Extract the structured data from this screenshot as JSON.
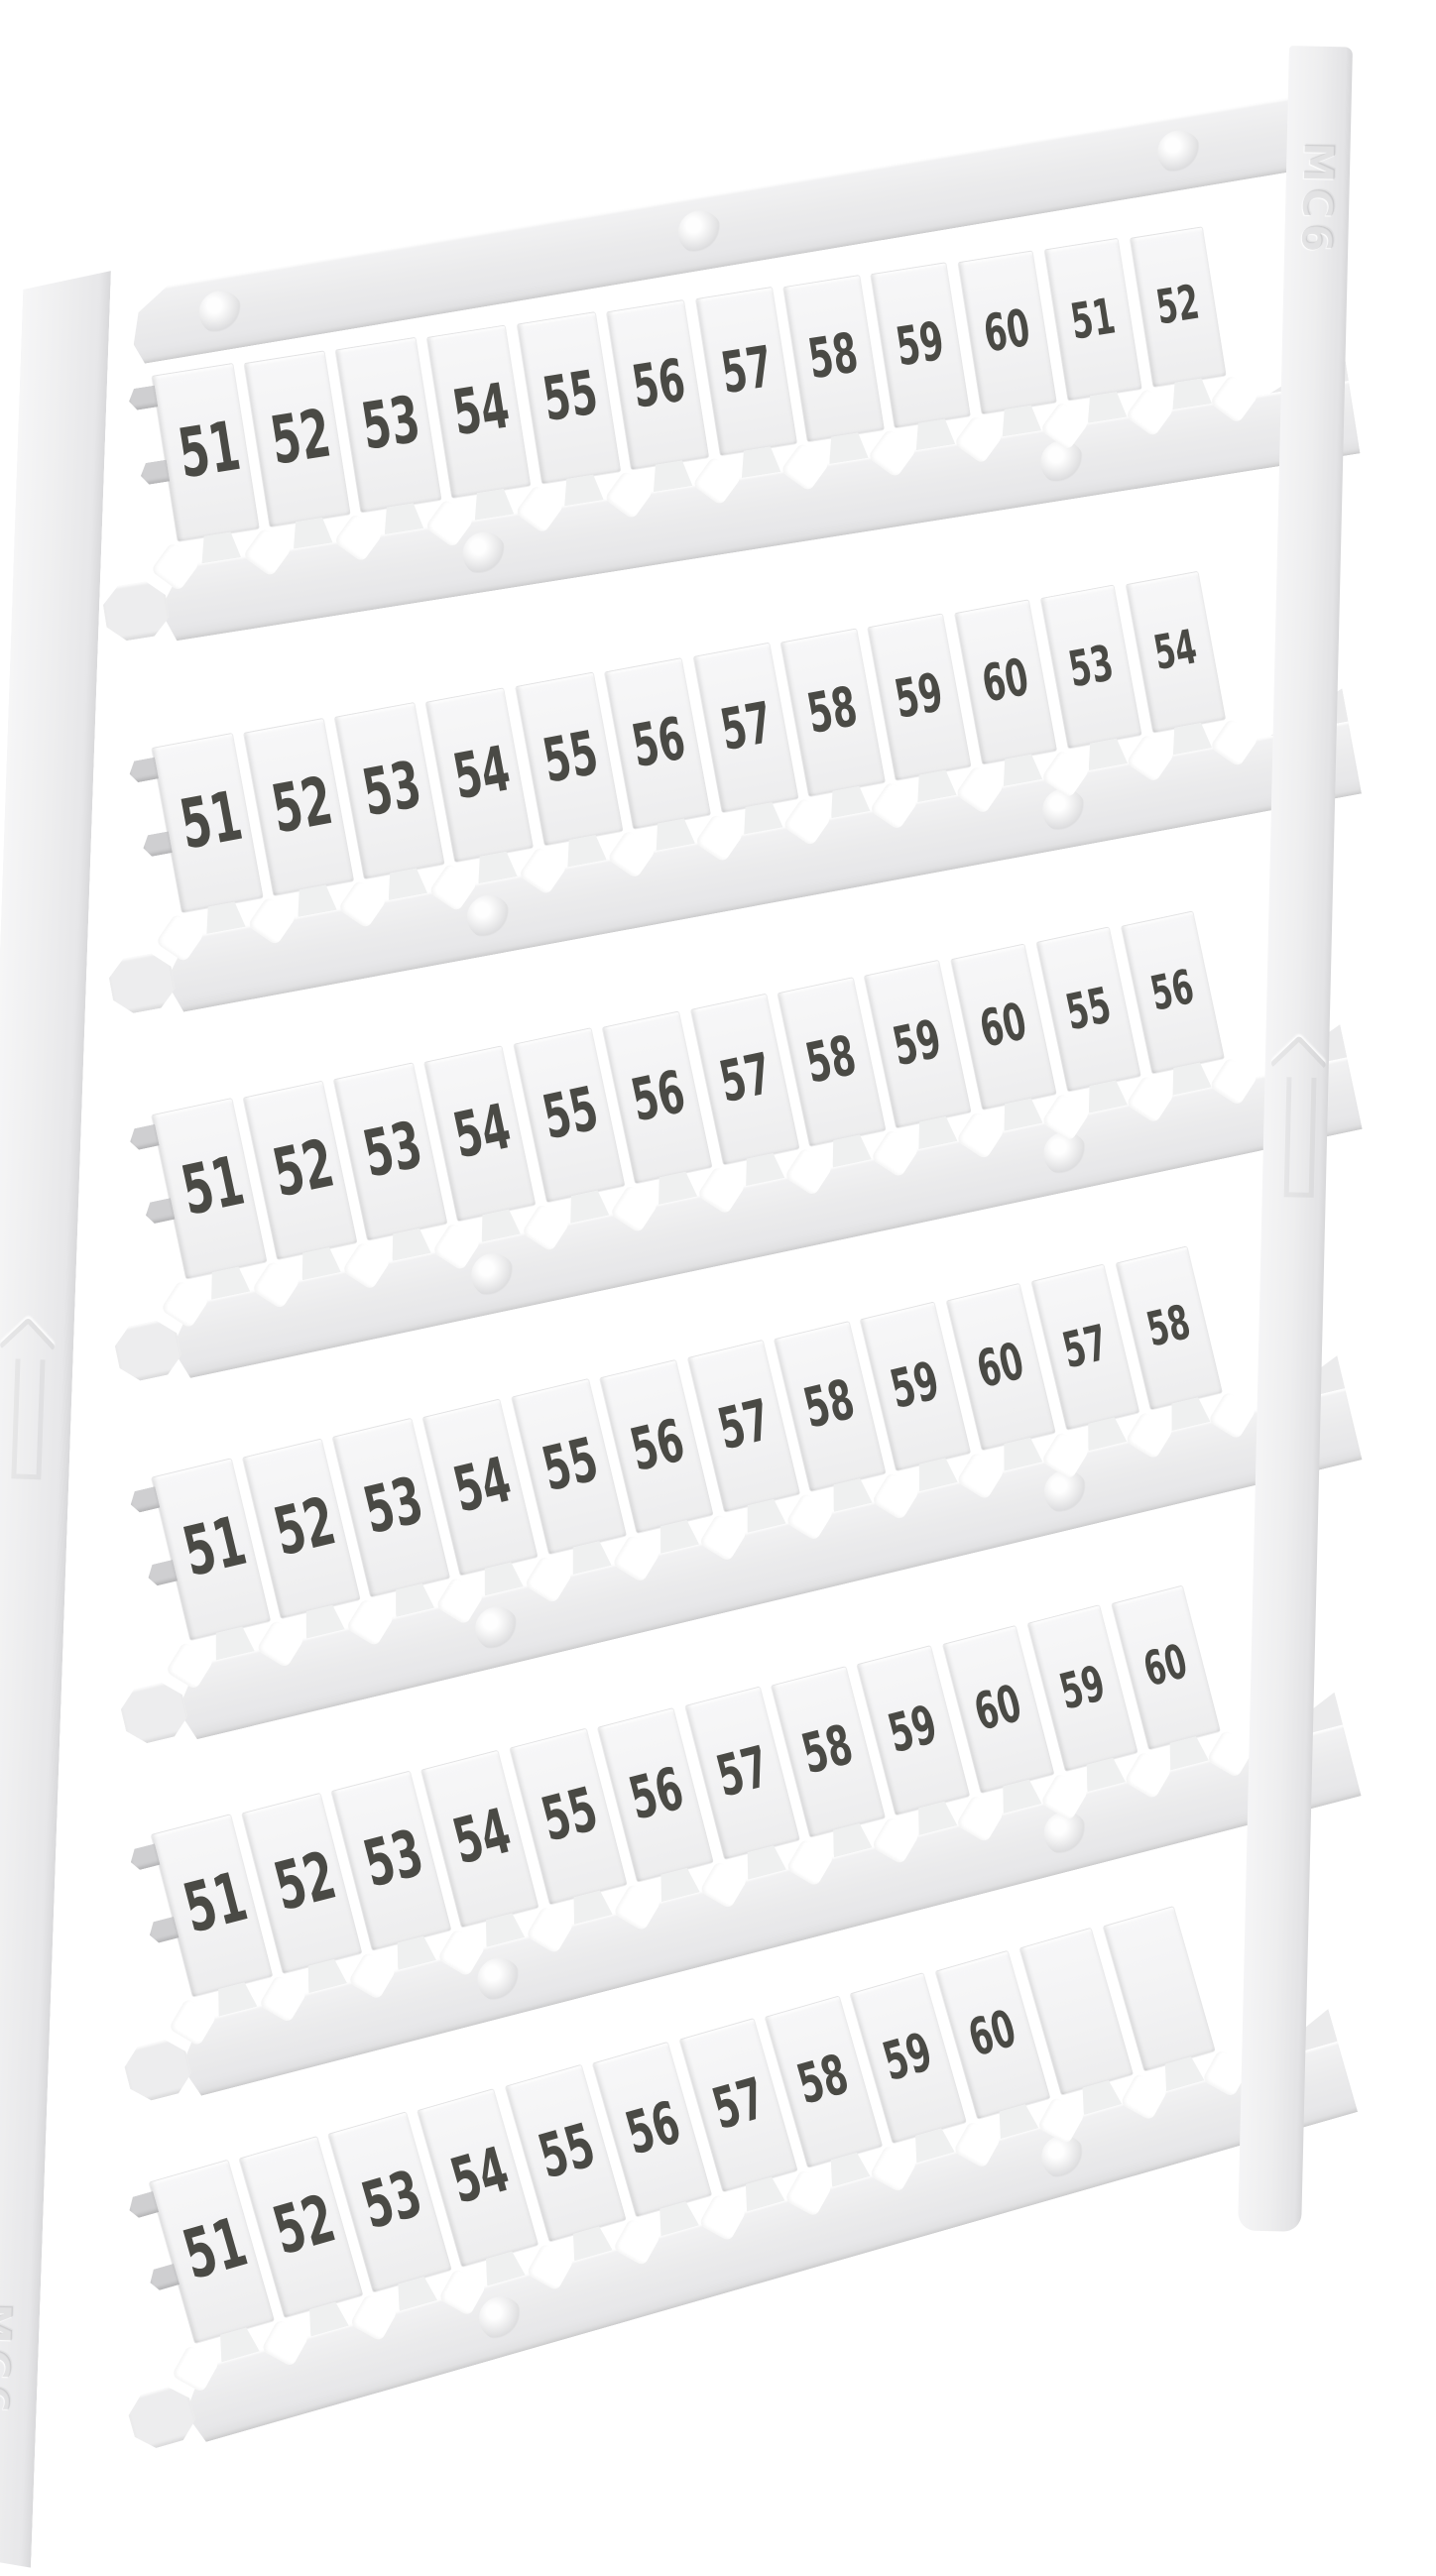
{
  "photo": {
    "description": "White plastic terminal-block marker card with snap-off numbered tags, photographed at an angle on a white background",
    "embossed_code": "MC6",
    "rows": [
      {
        "tags": [
          "51",
          "52",
          "53",
          "54",
          "55",
          "56",
          "57",
          "58",
          "59",
          "60",
          "51",
          "52"
        ]
      },
      {
        "tags": [
          "51",
          "52",
          "53",
          "54",
          "55",
          "56",
          "57",
          "58",
          "59",
          "60",
          "53",
          "54"
        ]
      },
      {
        "tags": [
          "51",
          "52",
          "53",
          "54",
          "55",
          "56",
          "57",
          "58",
          "59",
          "60",
          "55",
          "56"
        ]
      },
      {
        "tags": [
          "51",
          "52",
          "53",
          "54",
          "55",
          "56",
          "57",
          "58",
          "59",
          "60",
          "57",
          "58"
        ]
      },
      {
        "tags": [
          "51",
          "52",
          "53",
          "54",
          "55",
          "56",
          "57",
          "58",
          "59",
          "60",
          "59",
          "60"
        ]
      },
      {
        "tags": [
          "51",
          "52",
          "53",
          "54",
          "55",
          "56",
          "57",
          "58",
          "59",
          "60",
          "",
          ""
        ]
      }
    ],
    "colors": {
      "background": "#ffffff",
      "plastic": "#ececee",
      "plastic_dark": "#dfdfe1",
      "tag_face": "#f4f4f5",
      "digit": "#4a4a45"
    }
  }
}
